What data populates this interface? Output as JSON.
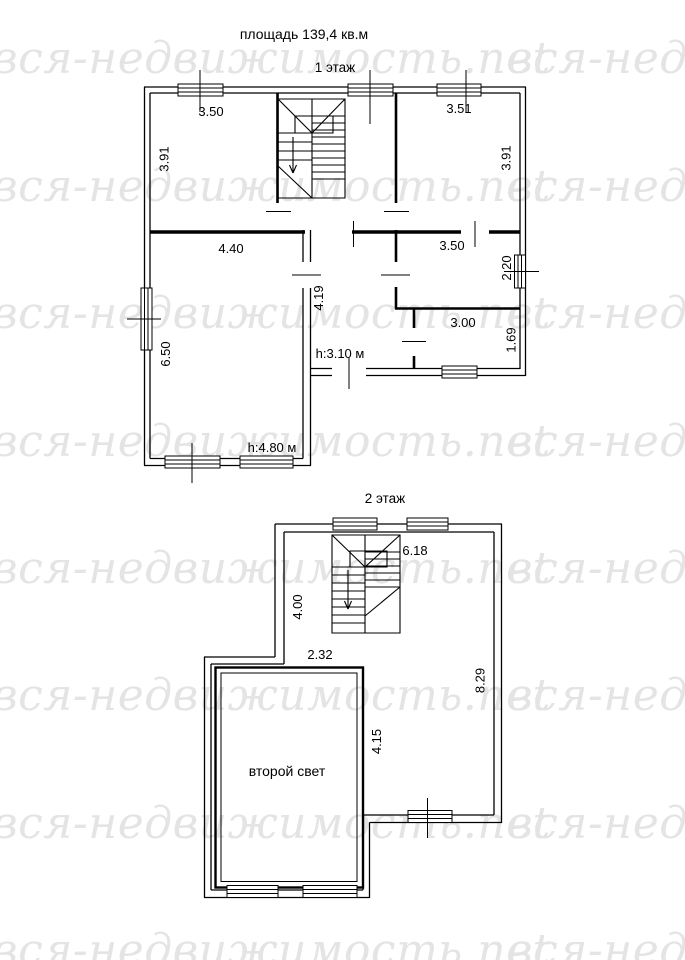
{
  "titles": {
    "area": "площадь 139,4 кв.м",
    "floor1": "1 этаж",
    "floor2": "2 этаж"
  },
  "watermark": {
    "text": "вся-недвижимость.net",
    "color": "#e4e4e4"
  },
  "colors": {
    "line": "#000000",
    "background": "#ffffff"
  },
  "floor1": {
    "rooms": {
      "top_left": {
        "width": "3.50",
        "height": "3.91"
      },
      "top_right": {
        "width": "3.51",
        "height": "3.91"
      },
      "living": {
        "width": "4.40",
        "height": "6.50",
        "ceiling": "h:4.80 м"
      },
      "hall": {
        "length": "4.19",
        "ceiling": "h:3.10 м"
      },
      "right_mid": {
        "width": "3.50",
        "height": "2.20"
      },
      "right_low": {
        "width": "3.00",
        "height": "1.69"
      }
    }
  },
  "floor2": {
    "rooms": {
      "main": {
        "width": "6.18",
        "height": "8.29"
      },
      "upper_left": {
        "height": "4.00"
      },
      "passage": {
        "width": "2.32"
      },
      "void": {
        "label": "второй свет",
        "height": "4.15"
      }
    }
  }
}
